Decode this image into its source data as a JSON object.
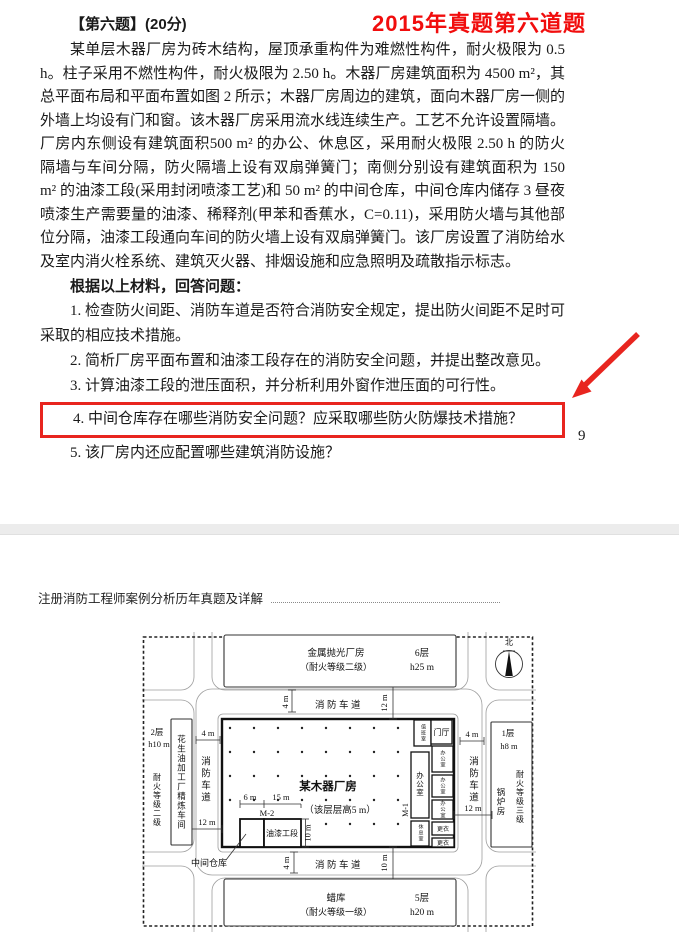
{
  "colors": {
    "highlight_red": "#e8251f",
    "annotation_red": "#f10d0d"
  },
  "page1": {
    "annotation": "2015年真题第六道题",
    "title": "【第六题】(20分)",
    "body": "某单层木器厂房为砖木结构，屋顶承重构件为难燃性构件，耐火极限为 0.5 h。柱子采用不燃性构件，耐火极限为 2.50 h。木器厂房建筑面积为 4500 m²，其总平面布局和平面布置如图 2 所示；木器厂房周边的建筑，面向木器厂房一侧的外墙上均设有门和窗。该木器厂房采用流水线连续生产。工艺不允许设置隔墙。厂房内东侧设有建筑面积500 m² 的办公、休息区，采用耐火极限 2.50 h 的防火隔墙与车间分隔，防火隔墙上设有双扇弹簧门；南侧分别设有建筑面积为 150 m² 的油漆工段(采用封闭喷漆工艺)和 50 m² 的中间仓库，中间仓库内储存 3 昼夜喷漆生产需要量的油漆、稀释剂(甲苯和香蕉水，C=0.11)，采用防火墙与其他部位分隔，油漆工段通向车间的防火墙上设有双扇弹簧门。该厂房设置了消防给水及室内消火栓系统、建筑灭火器、排烟设施和应急照明及疏散指示标志。",
    "prompt": "根据以上材料，回答问题：",
    "questions": {
      "q1": "1. 检查防火间距、消防车道是否符合消防安全规定，提出防火间距不足时可采取的相应技术措施。",
      "q2": "2. 简析厂房平面布置和油漆工段存在的消防安全问题，并提出整改意见。",
      "q3": "3. 计算油漆工段的泄压面积，并分析利用外窗作泄压面的可行性。",
      "q4": "4. 中间仓库存在哪些消防安全问题？应采取哪些防火防爆技术措施？",
      "q5": "5. 该厂房内还应配置哪些建筑消防设施？"
    },
    "page_number": "9"
  },
  "page2": {
    "header": "注册消防工程师案例分析历年真题及详解",
    "figure": {
      "north": "北",
      "fire_lane": "消防车道",
      "buildings": {
        "top": {
          "name": "金属抛光厂房",
          "rating": "（耐火等级二级）",
          "floors": "6层",
          "height": "h25 m"
        },
        "bottom": {
          "name": "蜡库",
          "rating": "（耐火等级一级）",
          "floors": "5层",
          "height": "h20 m"
        },
        "left": {
          "name": "花生油加工厂精炼车间",
          "floors": "2层",
          "height": "h10 m",
          "rating": "耐火等级二级"
        },
        "right": {
          "name": "锅炉房",
          "floors": "1层",
          "height": "h8 m",
          "rating": "耐火等级三级"
        },
        "main": {
          "name": "某木器厂房",
          "note": "（该层层高5 m）"
        }
      },
      "rooms": {
        "paint": "油漆工段",
        "warehouse": "中间仓库",
        "duty": "值班室",
        "hall": "门厅",
        "office_main": "办公室",
        "office_1": "办公室",
        "office_2": "办公室",
        "office_3": "办公室",
        "rest": "休息室",
        "locker_1": "更衣",
        "locker_2": "更衣"
      },
      "doors": {
        "m1": "M-1",
        "m2": "M-2"
      },
      "dims": {
        "four": "4 m",
        "twelve": "12 m",
        "ten": "10 m",
        "six": "6 m",
        "fifteen": "15 m"
      }
    }
  }
}
